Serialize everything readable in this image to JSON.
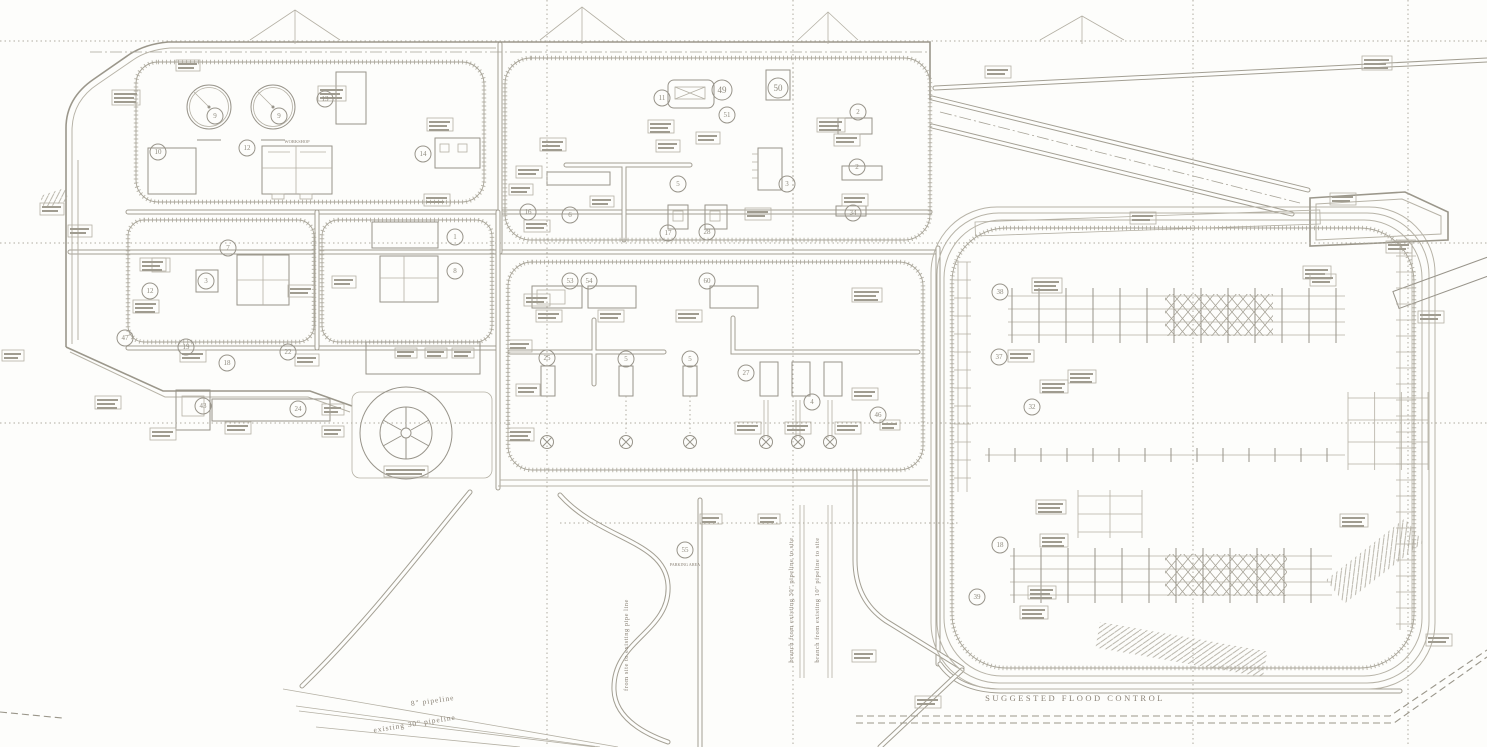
{
  "colors": {
    "background": "#fdfdfb",
    "ink_light": "#b4b0a4",
    "ink_mid": "#a39f93",
    "ink_dark": "#8f8b7f",
    "text": "#8a8276"
  },
  "labels": [
    {
      "text": "SUGGESTED FLOOD CONTROL",
      "x": 1075,
      "y": 701,
      "size": 8.5,
      "ls": 2.5,
      "rot": 0
    },
    {
      "text": "8\" pipeline",
      "x": 433,
      "y": 703,
      "size": 7.5,
      "ls": 1,
      "rot": -8
    },
    {
      "text": "existing 30\" pipeline",
      "x": 415,
      "y": 726,
      "size": 7.5,
      "ls": 1,
      "rot": -9
    },
    {
      "text": "branch from existing 30\" pipeline to site",
      "x": 793,
      "y": 600,
      "size": 6.5,
      "ls": 0.5,
      "rot": -90
    },
    {
      "text": "branch from existing 10\" pipeline to site",
      "x": 819,
      "y": 600,
      "size": 6.5,
      "ls": 0.5,
      "rot": -90
    },
    {
      "text": "from site to existing pipe line",
      "x": 628,
      "y": 645,
      "size": 6.5,
      "ls": 0.5,
      "rot": -90
    },
    {
      "text": "WORKSHOP",
      "x": 297,
      "y": 143,
      "size": 4.5,
      "ls": 0,
      "rot": 0
    },
    {
      "text": "PARKING AREA",
      "x": 685,
      "y": 566,
      "size": 4.2,
      "ls": 0,
      "rot": 0
    }
  ],
  "plan": {
    "grid": {
      "v": [
        547,
        793,
        1193,
        1408
      ],
      "h": [
        41,
        243,
        423
      ]
    },
    "tank_r": 22,
    "tanks": [
      {
        "cx": 209,
        "cy": 107
      },
      {
        "cx": 273,
        "cy": 107
      }
    ],
    "callouts": [
      [
        "9",
        215,
        116
      ],
      [
        "9",
        279,
        116
      ],
      [
        "10",
        158,
        152
      ],
      [
        "12",
        247,
        148
      ],
      [
        "13",
        325,
        99
      ],
      [
        "14",
        423,
        154
      ],
      [
        "7",
        228,
        248
      ],
      [
        "3",
        206,
        281
      ],
      [
        "12",
        150,
        291
      ],
      [
        "1",
        455,
        237
      ],
      [
        "8",
        455,
        271
      ],
      [
        "47",
        125,
        338
      ],
      [
        "19",
        186,
        347
      ],
      [
        "18",
        227,
        363
      ],
      [
        "22",
        288,
        352
      ],
      [
        "43",
        203,
        406
      ],
      [
        "24",
        298,
        409
      ],
      [
        "11",
        662,
        98
      ],
      [
        "49",
        722,
        90,
        10
      ],
      [
        "51",
        727,
        115
      ],
      [
        "50",
        778,
        88,
        10
      ],
      [
        "2",
        858,
        112
      ],
      [
        "2",
        857,
        167
      ],
      [
        "34",
        853,
        213
      ],
      [
        "3",
        787,
        184
      ],
      [
        "5",
        678,
        184
      ],
      [
        "16",
        528,
        212
      ],
      [
        "6",
        570,
        215
      ],
      [
        "17",
        668,
        233
      ],
      [
        "28",
        707,
        232
      ],
      [
        "53",
        570,
        281
      ],
      [
        "54",
        589,
        281
      ],
      [
        "60",
        707,
        281
      ],
      [
        "25",
        547,
        358
      ],
      [
        "5",
        626,
        359
      ],
      [
        "5",
        690,
        359
      ],
      [
        "27",
        746,
        373
      ],
      [
        "4",
        812,
        402
      ],
      [
        "46",
        878,
        415
      ],
      [
        "38",
        1000,
        292
      ],
      [
        "37",
        999,
        357
      ],
      [
        "32",
        1032,
        407
      ],
      [
        "18",
        1000,
        545
      ],
      [
        "39",
        977,
        597
      ],
      [
        "55",
        685,
        550
      ]
    ],
    "boxes": [
      [
        112,
        90,
        28,
        15
      ],
      [
        318,
        86,
        28,
        15
      ],
      [
        40,
        203,
        24,
        12
      ],
      [
        2,
        350,
        22,
        11
      ],
      [
        176,
        60,
        24,
        11
      ],
      [
        68,
        225,
        24,
        12
      ],
      [
        140,
        258,
        26,
        13
      ],
      [
        133,
        300,
        26,
        13
      ],
      [
        288,
        285,
        26,
        12
      ],
      [
        332,
        276,
        24,
        12
      ],
      [
        427,
        118,
        26,
        13
      ],
      [
        424,
        194,
        26,
        12
      ],
      [
        540,
        138,
        26,
        13
      ],
      [
        516,
        166,
        26,
        12
      ],
      [
        509,
        184,
        24,
        11
      ],
      [
        648,
        120,
        26,
        13
      ],
      [
        696,
        132,
        24,
        12
      ],
      [
        817,
        118,
        28,
        14
      ],
      [
        834,
        134,
        26,
        12
      ],
      [
        842,
        194,
        26,
        12
      ],
      [
        745,
        208,
        26,
        12
      ],
      [
        524,
        220,
        26,
        12
      ],
      [
        524,
        294,
        26,
        12
      ],
      [
        536,
        310,
        26,
        12
      ],
      [
        598,
        310,
        26,
        12
      ],
      [
        676,
        310,
        26,
        12
      ],
      [
        508,
        340,
        24,
        12
      ],
      [
        516,
        384,
        24,
        12
      ],
      [
        508,
        428,
        26,
        13
      ],
      [
        735,
        422,
        26,
        12
      ],
      [
        785,
        422,
        26,
        12
      ],
      [
        835,
        422,
        26,
        12
      ],
      [
        852,
        388,
        26,
        12
      ],
      [
        852,
        288,
        30,
        14
      ],
      [
        395,
        348,
        22,
        10
      ],
      [
        425,
        348,
        22,
        10
      ],
      [
        452,
        348,
        22,
        10
      ],
      [
        180,
        350,
        26,
        12
      ],
      [
        225,
        422,
        26,
        12
      ],
      [
        95,
        396,
        26,
        13
      ],
      [
        150,
        428,
        26,
        12
      ],
      [
        295,
        354,
        24,
        12
      ],
      [
        322,
        404,
        22,
        11
      ],
      [
        322,
        426,
        22,
        11
      ],
      [
        384,
        466,
        44,
        11
      ],
      [
        1032,
        278,
        30,
        15
      ],
      [
        1303,
        266,
        28,
        13
      ],
      [
        1008,
        350,
        26,
        12
      ],
      [
        1040,
        380,
        28,
        13
      ],
      [
        1068,
        370,
        28,
        13
      ],
      [
        1036,
        500,
        30,
        14
      ],
      [
        1040,
        534,
        28,
        13
      ],
      [
        1028,
        586,
        28,
        13
      ],
      [
        1020,
        606,
        28,
        13
      ],
      [
        1340,
        514,
        28,
        13
      ],
      [
        1362,
        56,
        30,
        14
      ],
      [
        1330,
        193,
        26,
        12
      ],
      [
        1386,
        241,
        26,
        12
      ],
      [
        1310,
        274,
        26,
        12
      ],
      [
        1418,
        311,
        26,
        12
      ],
      [
        1426,
        634,
        26,
        12
      ],
      [
        915,
        696,
        26,
        12
      ],
      [
        852,
        650,
        24,
        12
      ],
      [
        985,
        66,
        26,
        12
      ],
      [
        1130,
        212,
        26,
        12
      ],
      [
        700,
        514,
        22,
        10
      ],
      [
        758,
        514,
        22,
        10
      ],
      [
        880,
        420,
        20,
        10
      ],
      [
        656,
        140,
        24,
        12
      ],
      [
        590,
        196,
        24,
        11
      ]
    ],
    "racks": [
      {
        "x": 1008,
        "y": 296,
        "w": 337,
        "rows": 4,
        "gap": 13,
        "te": 27,
        "tp": 8
      },
      {
        "x": 1010,
        "y": 556,
        "w": 322,
        "rows": 4,
        "gap": 13,
        "te": 27,
        "tp": 8
      },
      {
        "x": 985,
        "y": 455,
        "w": 360,
        "rows": 1,
        "gap": 0,
        "te": 26,
        "tp": 7
      }
    ],
    "vracks": [
      {
        "x": 1400,
        "y": 240,
        "h": 390,
        "cols": 2,
        "gap": 12,
        "te": 16
      },
      {
        "x": 958,
        "y": 262,
        "h": 230,
        "cols": 2,
        "gap": 9,
        "te": 18
      }
    ],
    "gridpatches": [
      {
        "x": 1348,
        "y": 398,
        "w": 80,
        "h": 66,
        "hn": 4,
        "vn": 4
      },
      {
        "x": 1078,
        "y": 496,
        "w": 64,
        "h": 36,
        "hn": 3,
        "vn": 3
      }
    ],
    "valves": [
      [
        547,
        442
      ],
      [
        626,
        442
      ],
      [
        690,
        442
      ],
      [
        766,
        442
      ],
      [
        798,
        442
      ],
      [
        830,
        442
      ]
    ],
    "terrain": [
      [
        250,
        295,
        340,
        10
      ],
      [
        540,
        582,
        625,
        7
      ],
      [
        798,
        828,
        858,
        12
      ],
      [
        1040,
        1082,
        1124,
        16
      ]
    ],
    "xbraces": [
      [
        1165,
        294,
        108,
        42
      ],
      [
        1165,
        554,
        122,
        42
      ]
    ],
    "parking": {
      "x": 975,
      "y": 222,
      "w": 345,
      "h": 14,
      "rot": -2
    }
  }
}
